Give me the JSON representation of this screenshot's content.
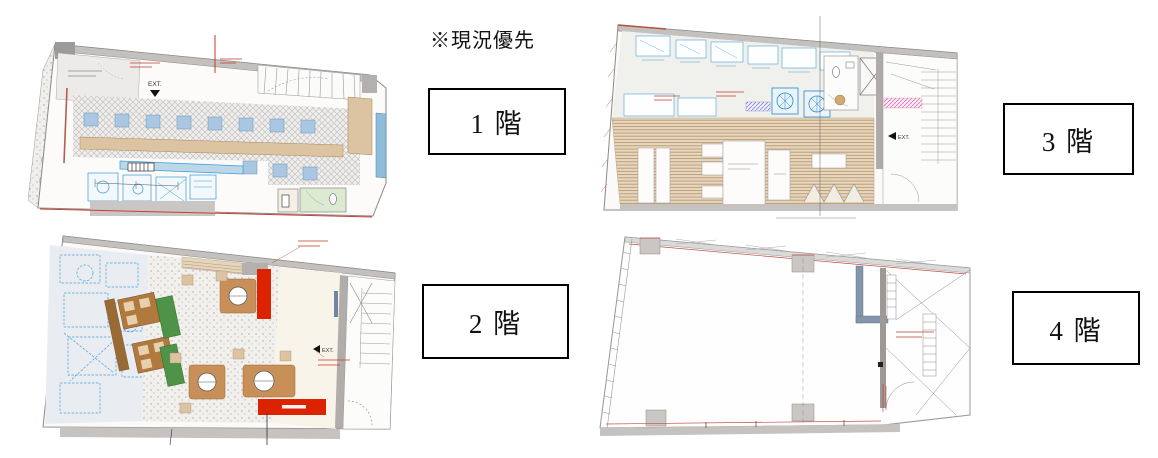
{
  "note": {
    "text": "※現況優先"
  },
  "floor_labels": [
    {
      "label": "1 階"
    },
    {
      "label": "2 階"
    },
    {
      "label": "3 階"
    },
    {
      "label": "4 階"
    }
  ],
  "plans": {
    "floor1": {
      "exit_label": "EXT."
    },
    "floor2": {
      "exit_label": "EXT."
    },
    "floor3": {
      "exit_label": "EXT."
    }
  },
  "colors": {
    "wall_gray": "#c3c0bd",
    "seat_blue": "#a9c7e3",
    "counter_tan": "#dcc3a2",
    "table_brown": "#b07a3f",
    "round_table_brown": "#c89058",
    "panel_green": "#4e9347",
    "accent_red": "#dd2200",
    "annotation_red": "#c33a2a",
    "equipment_blue": "#3a9bd5",
    "wood_floor": "#e8d7bc",
    "toilet_green": "#dcead2",
    "steel_blue_wall": "#8495aa"
  }
}
